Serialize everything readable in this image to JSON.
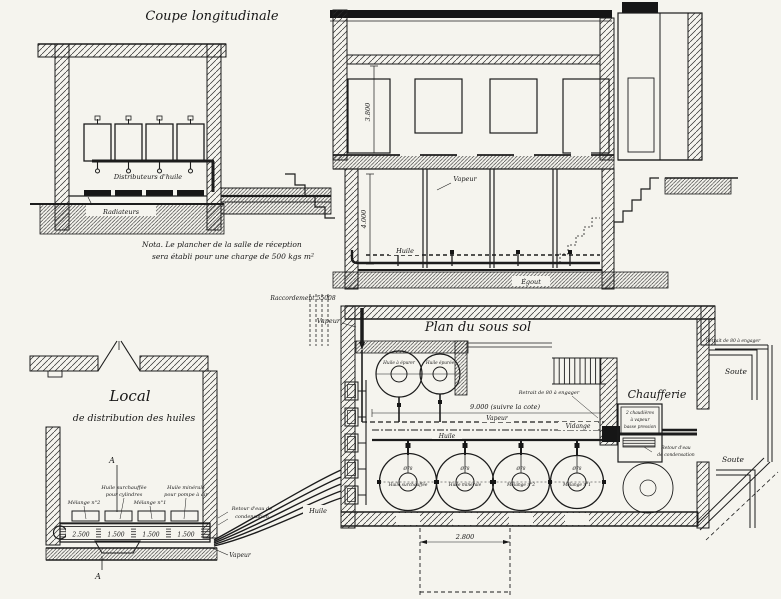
{
  "coupe": {
    "title": "Coupe longitudinale",
    "distributeurs": "Distributeurs d'huile",
    "radiateurs": "Radiateurs",
    "note1": "Nota. Le plancher de la salle de réception",
    "note2": "sera établi pour une charge de 500 kgs m²"
  },
  "section": {
    "dim_hauteur": "3.800",
    "dim_cave": "4.000",
    "vapeur": "Vapeur",
    "huile": "Huile",
    "egout": "Égout"
  },
  "plan": {
    "title": "Plan du sous sol",
    "raccordement": "Raccordement 55008",
    "vapeur_riser": "Vapeur",
    "retrait": "Retrait de 80 à engager",
    "retrait2": "Retrait de 80 à engager",
    "dim_largeur": "9.000 (suivre la cote)",
    "vapeur": "Vapeur",
    "vidange": "Vidange",
    "huile": "Huile",
    "huile_sortie": "Huile",
    "chaufferie": "Chaufferie",
    "chaudieres": [
      "2 chaudières",
      "à vapeur",
      "basse pression"
    ],
    "retour": [
      "Retour d'eau",
      "de condensation"
    ],
    "soute_haut": "Soute",
    "soute_bas": "Soute",
    "dim_fosse": "2.800",
    "petites_cuves": [
      "Huile à épurer",
      "Huile épurée"
    ],
    "cuves": [
      {
        "dia": "Ø78",
        "nom": "Huile surchauffée"
      },
      {
        "dia": "Ø78",
        "nom": "Huile minérale"
      },
      {
        "dia": "Ø78",
        "nom": "Mélange n°2"
      },
      {
        "dia": "Ø78",
        "nom": "Mélange n°1"
      }
    ]
  },
  "local": {
    "titre": "Local",
    "sous_titre": "de distribution des huiles",
    "repere": "A",
    "huile_surchauffee": [
      "Huile surchauffée",
      "pour cylindres"
    ],
    "melange2": "Mélange n°2",
    "melange1": "Mélange n°1",
    "huile_minerale": [
      "Huile minérale",
      "pour pompe à air"
    ],
    "retour": [
      "Retour d'eau de",
      "condensation"
    ],
    "vapeur": "Vapeur",
    "reservoirs": [
      "2.500",
      "1.500",
      "1.500",
      "1.500"
    ]
  }
}
